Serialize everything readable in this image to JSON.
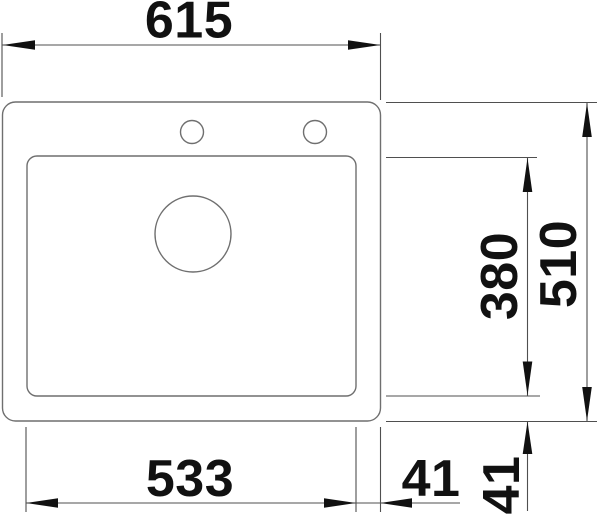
{
  "document": {
    "type": "technical dimension drawing",
    "subject": "drop-in single-bowl sink, top view",
    "units": "mm"
  },
  "dimensions": {
    "overall_width": "615",
    "overall_depth": "510",
    "bowl_depth": "380",
    "bowl_width": "533",
    "bowl_to_right_edge": "41",
    "bowl_to_bottom_edge": "41"
  },
  "features": {
    "faucet_holes": 2,
    "drain_holes": 1
  },
  "colors": {
    "background": "#ffffff",
    "outline": "#6f6f6f",
    "dimension_line": "#4f4f4f",
    "ink": "#111111"
  }
}
